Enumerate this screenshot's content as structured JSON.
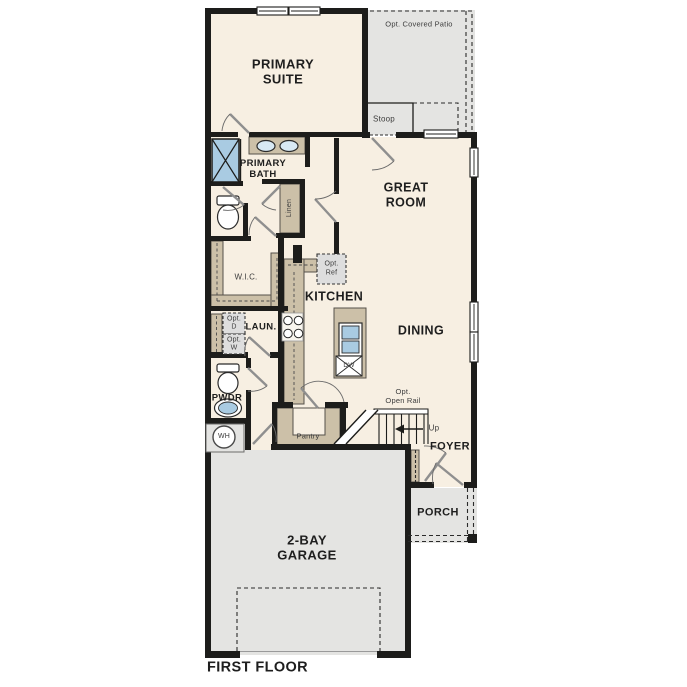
{
  "plan_title": "FIRST FLOOR",
  "labels": {
    "primary_suite": "PRIMARY\nSUITE",
    "covered_patio": "Opt. Covered Patio",
    "stoop": "Stoop",
    "primary_bath": "PRIMARY\nBATH",
    "linen": "Linen",
    "great_room": "GREAT\nROOM",
    "wic": "W.I.C.",
    "opt_ref": "Opt.\nRef",
    "kitchen": "KITCHEN",
    "dining": "DINING",
    "laundry": "LAUN.",
    "opt_dryer": "Opt.\nD",
    "opt_washer": "Opt.\nW",
    "powder": "PWDR",
    "water_heater": "WH",
    "pantry": "Pantry",
    "opt_open_rail": "Opt.\nOpen Rail",
    "stairs_up": "Up",
    "foyer": "FOYER",
    "porch": "PORCH",
    "garage": "2-BAY\nGARAGE",
    "dishwasher": "DW",
    "title": "FIRST FLOOR"
  },
  "colors": {
    "wall": "#1d1d1b",
    "interior_floor": "#f7efe2",
    "outdoor_gray": "#e4e4e2",
    "cabinet_tan": "#ccc0a8",
    "fixture_blue": "#a9cbe2",
    "opt_box_gray": "#dedede"
  }
}
